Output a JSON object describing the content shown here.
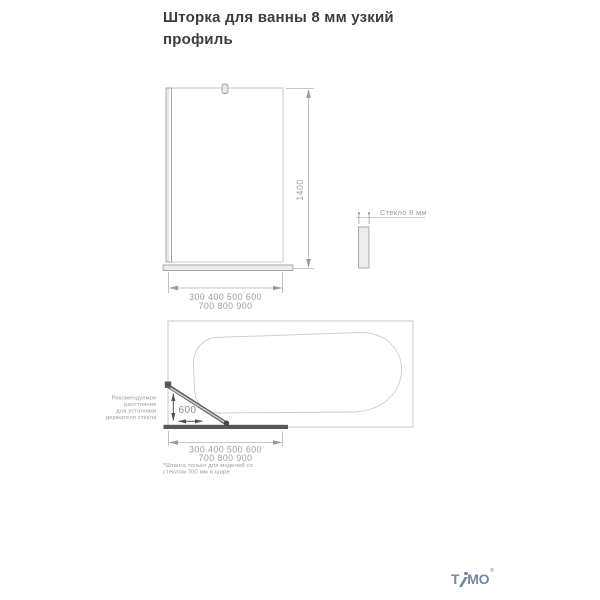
{
  "page": {
    "title": "Шторка для ванны 8 мм узкий профиль"
  },
  "front_view": {
    "height_label": "1400",
    "width_labels_line1": "300 400 500 600",
    "width_labels_line2": "700 800 900"
  },
  "glass_detail": {
    "label": "Стекло 8 мм"
  },
  "plan_view": {
    "distance_label": "600",
    "holder_note_lines": [
      "Рекомендуемое",
      "расстояние",
      "для установки",
      "держателя стекла"
    ],
    "width_labels_line1": "300 400 500 600",
    "width_labels_line2": "700 800 900",
    "footnote_lines": [
      "*Штанга только для моделей со",
      "стеклом 700 мм и шире"
    ]
  },
  "branding": {
    "logo_text": "TIMO",
    "logo_part1": "T",
    "logo_part2": "MO",
    "registered_mark": "®"
  },
  "colors": {
    "title_text": "#3d3d3d",
    "drawing_line": "#c5c7c9",
    "dimension_text": "#9c9c9c",
    "dark_element": "#54585c",
    "logo": "#75889d"
  }
}
